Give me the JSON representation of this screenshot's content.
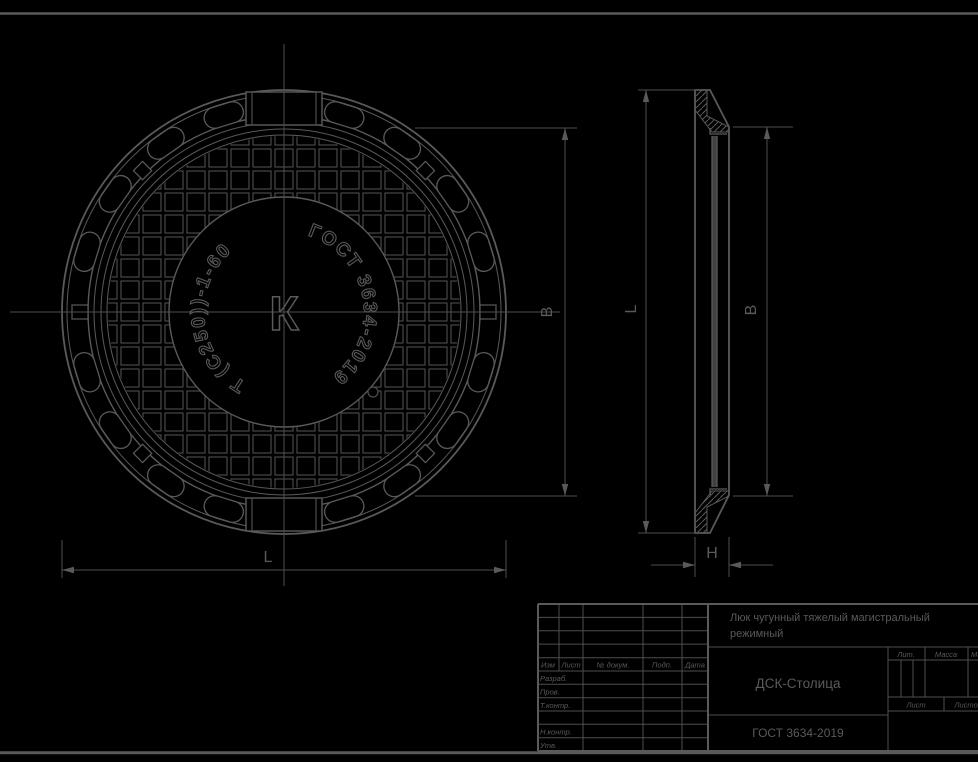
{
  "colors": {
    "background": "#000000",
    "line": "#5a5a5a"
  },
  "plan_view": {
    "marking_left": "Т (С250))-1-60",
    "marking_right": "ГОСТ 3634-2019",
    "center_letter": "К"
  },
  "dims": {
    "L": "L",
    "B": "B",
    "H": "H"
  },
  "title_block": {
    "description_line1": "Люк чугунный тяжелый магистральный",
    "description_line2": "режимный",
    "company": "ДСК-Столица",
    "standard": "ГОСТ 3634-2019",
    "header_cols": [
      "Изм",
      "Лист",
      "№ докум.",
      "Подп.",
      "Дата"
    ],
    "row_labels": [
      "Разраб.",
      "Пров.",
      "Т.контр.",
      "Н.контр.",
      "Утв."
    ],
    "lit_label": "Лит.",
    "mass_label": "Масса",
    "scale_label": "Масштаб",
    "sheet_label": "Лист",
    "sheets_label": "Листов"
  }
}
